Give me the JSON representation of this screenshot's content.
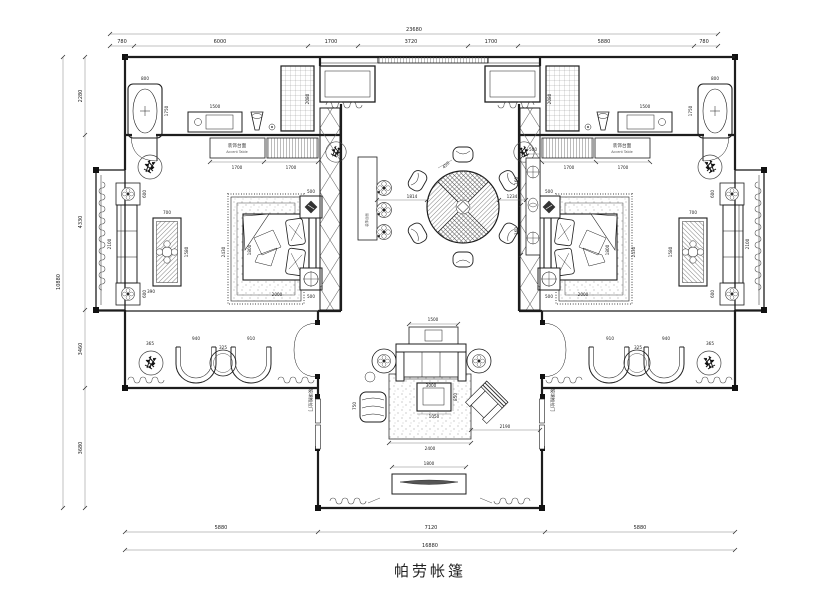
{
  "title": {
    "text": "帕劳帐篷"
  },
  "dims": {
    "top": {
      "total": "23680",
      "segs": [
        "780",
        "6000",
        "1700",
        "3720",
        "1700",
        "5880",
        "780"
      ]
    },
    "left": {
      "total": "10880",
      "segs": [
        "2280",
        "4330",
        "3460",
        "3680"
      ]
    },
    "bottom": {
      "total": "16880",
      "segs": [
        "5880",
        "7120",
        "5880"
      ]
    }
  },
  "labels": {
    "accent_cn": "装饰台面",
    "accent_en": "Accent Table",
    "sliding_door": "玻璃推拉门"
  },
  "fdims": {
    "tub_w": "800",
    "tub_l": "1750",
    "vanity": "1500",
    "shower": "2080",
    "accent_a": "1700",
    "accent_b": "1700",
    "seat_side": "600",
    "seat_len": "2100",
    "tea_w": "700",
    "tea_l": "1580",
    "tea_gap": "390",
    "bed_zone": "2430",
    "bed_w": "1800",
    "bed_l": "2000",
    "nightstand": "500",
    "chair_a": "940",
    "chair_table": "325",
    "chair_b": "910",
    "plant": "365",
    "table_top": "450",
    "table_left": "1814",
    "table_right": "1234",
    "console_w": "500",
    "console_s": "160",
    "sofa_console": "1500",
    "sofa": "3000",
    "coffee_l": "850",
    "coffee_w": "1050",
    "rug": "2400",
    "terrace": "2190",
    "tv": "1800",
    "chaise": "750"
  }
}
